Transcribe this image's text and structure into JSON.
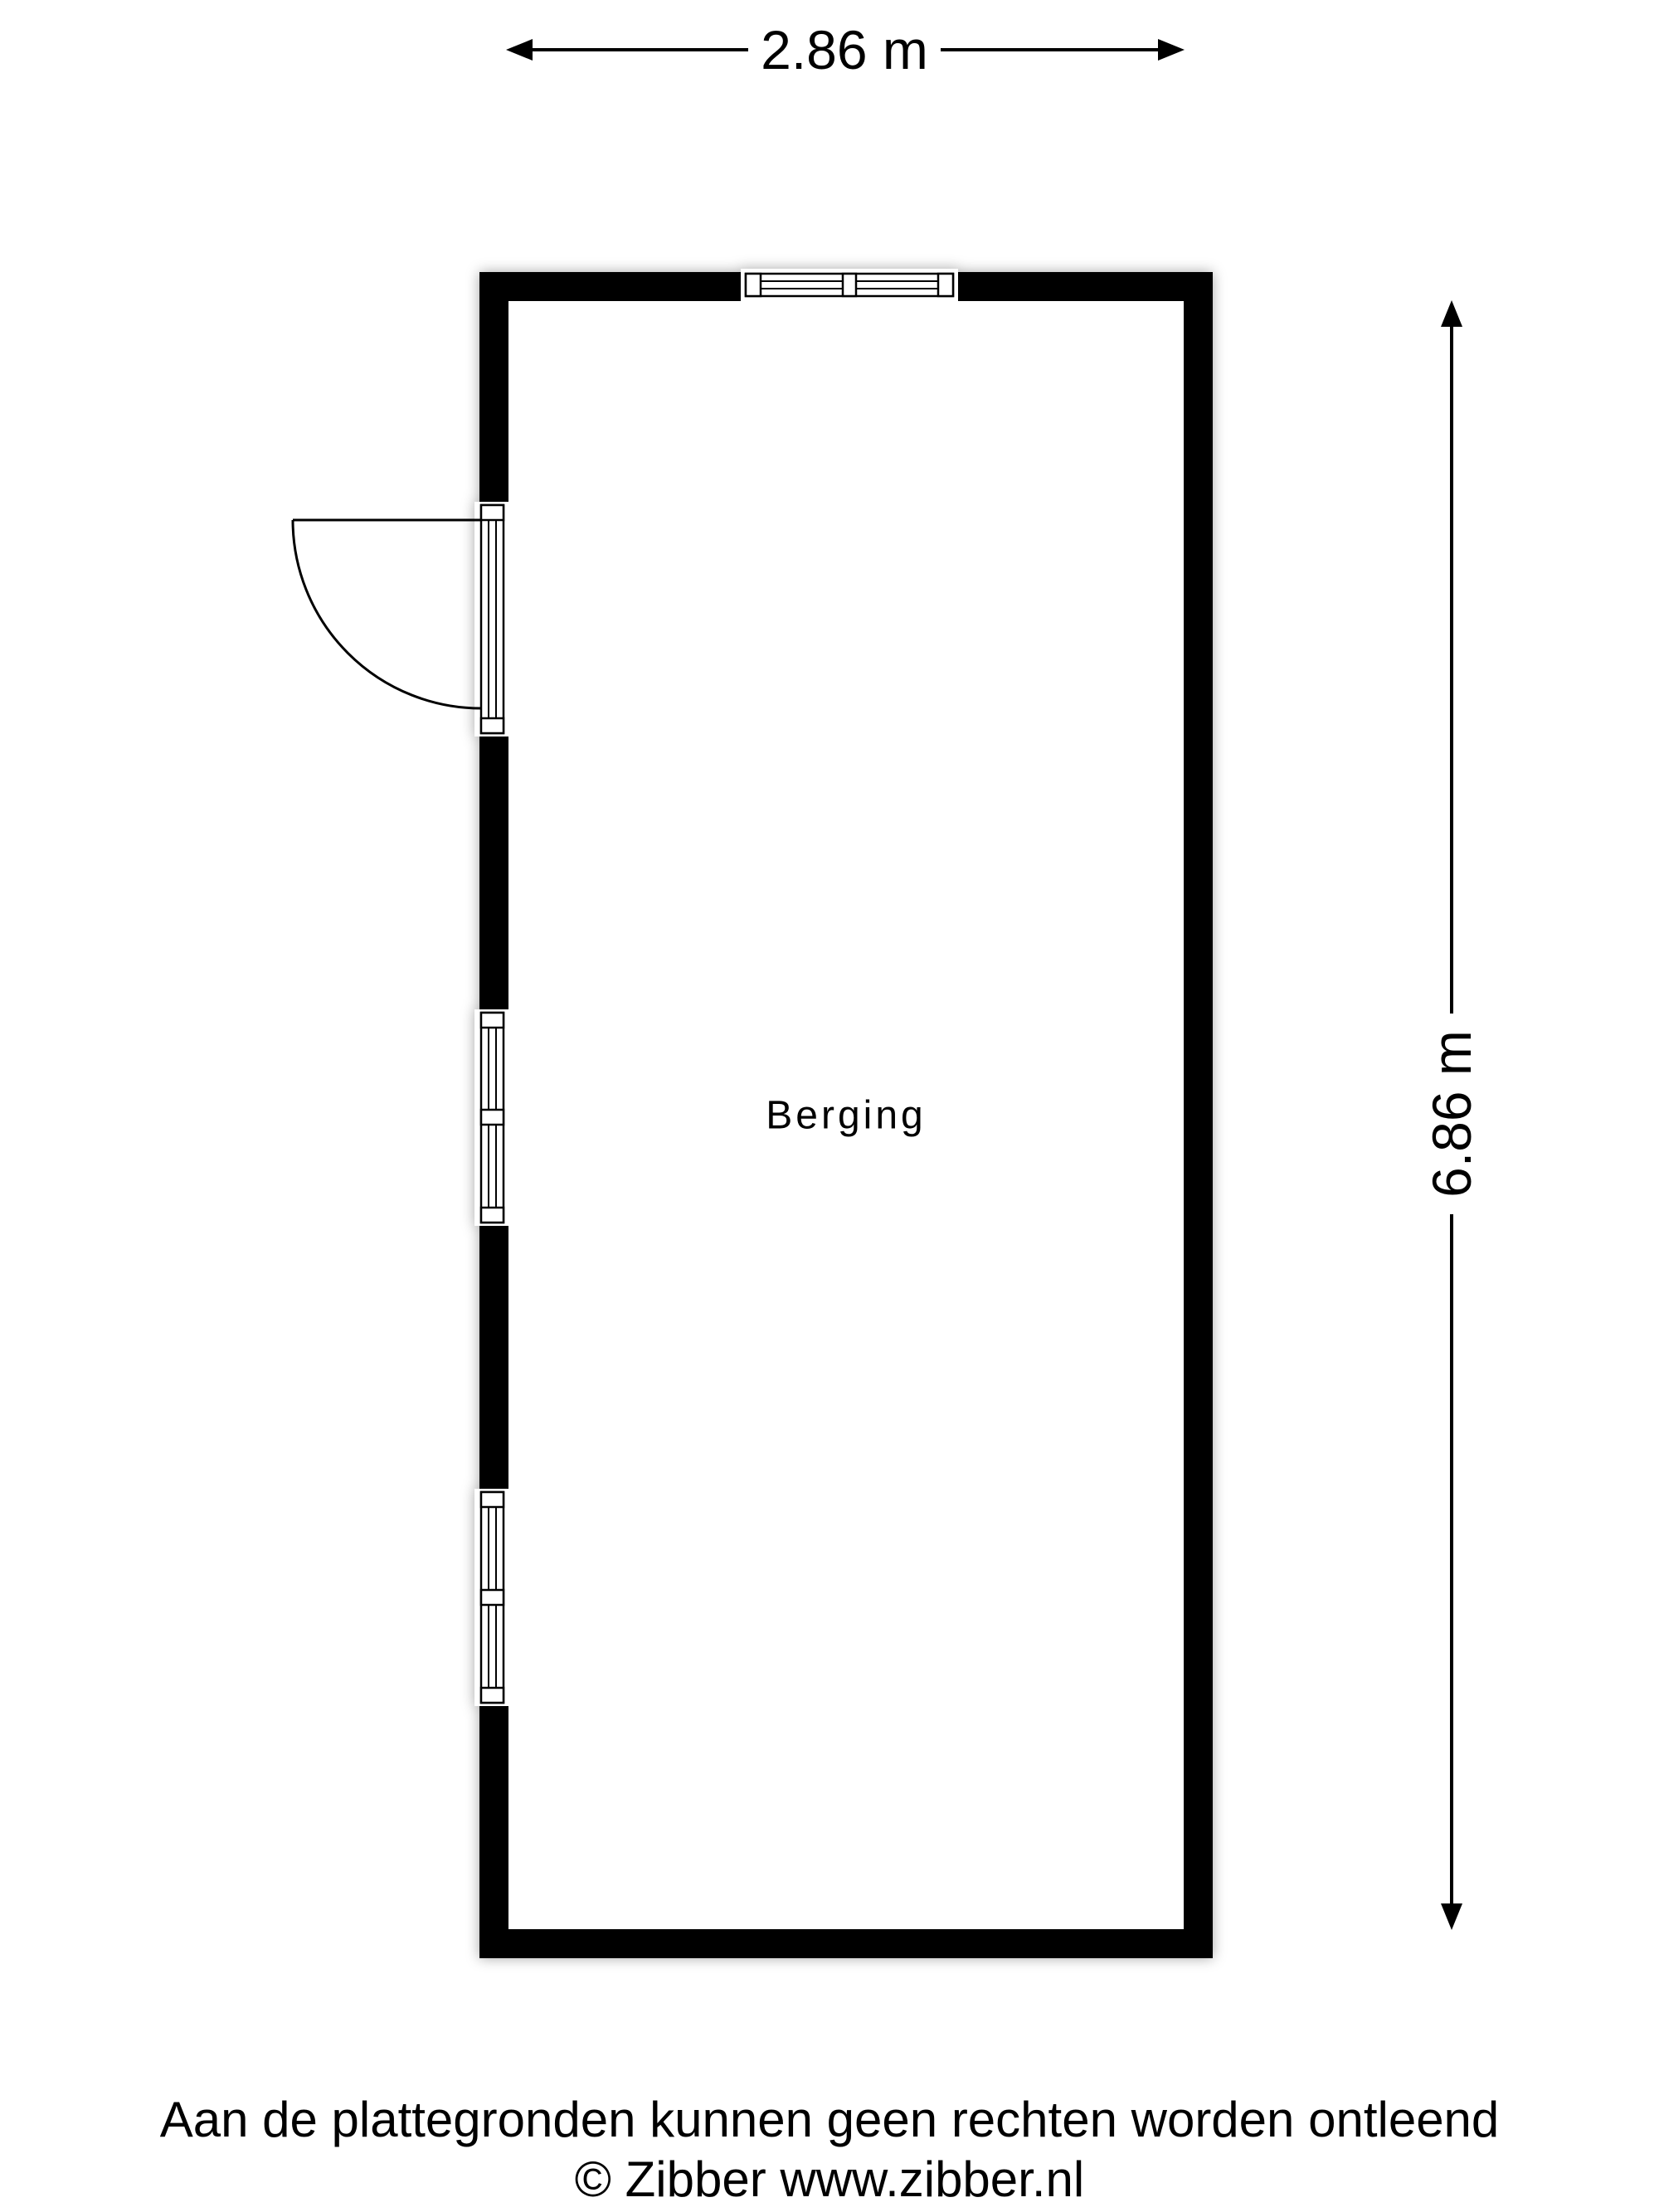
{
  "floor_plan": {
    "dimensions": {
      "width": "2.86 m",
      "height": "6.86 m"
    },
    "rooms": [
      {
        "name": "Berging"
      }
    ],
    "features": {
      "door": "hinged-door-left-wall",
      "windows": [
        "top-wall-window",
        "left-wall-window-middle",
        "left-wall-window-lower"
      ]
    },
    "colors": {
      "wall": "#000000",
      "background": "#ffffff",
      "line": "#000000",
      "shadow": "rgba(0,0,0,0.35)"
    }
  },
  "footer": {
    "disclaimer": "Aan de plattegronden kunnen geen rechten worden ontleend",
    "copyright": "© Zibber www.zibber.nl"
  }
}
